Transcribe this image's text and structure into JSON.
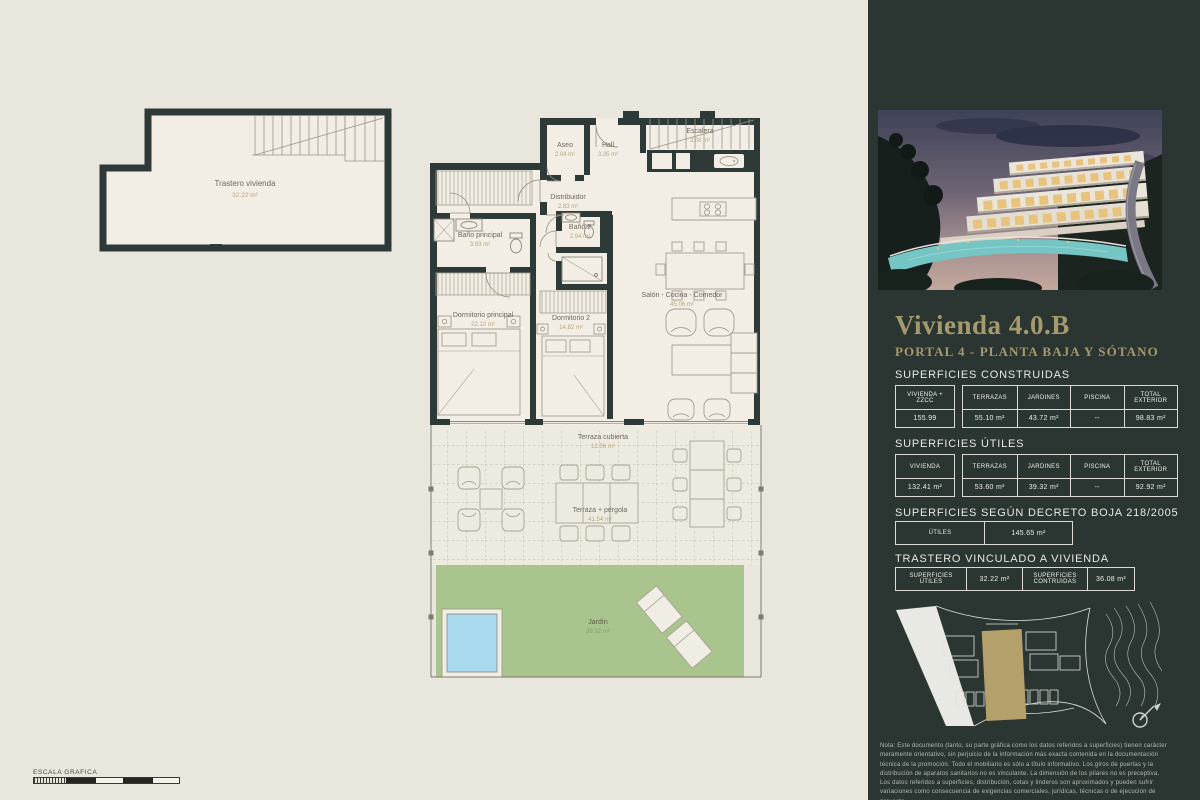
{
  "colors": {
    "accent_gold": "#a59a6c",
    "sidebar_bg": "#2b3532",
    "wall": "#2e3a38",
    "garden_green": "#a9c48c",
    "pool_blue": "#a9d9ef",
    "floor": "#f2eee5"
  },
  "floorplan": {
    "trastero": {
      "name": "Trastero vivienda",
      "area": "32.22 m²"
    },
    "rooms": {
      "aseo": {
        "name": "Aseo",
        "area": "2.04 m²"
      },
      "hall": {
        "name": "Hall",
        "area": "3.35 m²"
      },
      "escalera": {
        "name": "Escalera",
        "area": "3.08 m²"
      },
      "distribuidor": {
        "name": "Distribuidor",
        "area": "2.83 m²"
      },
      "bano_principal": {
        "name": "Baño principal",
        "area": "3.63 m²"
      },
      "bano2": {
        "name": "Baño 2",
        "area": "2.94 m²"
      },
      "dormitorio_principal": {
        "name": "Dormitorio principal",
        "area": "22.12 m²"
      },
      "dormitorio2": {
        "name": "Dormitorio 2",
        "area": "14.82 m²"
      },
      "salon": {
        "name": "Salón - Cocina - Comedor",
        "area": "45.06 m²"
      },
      "terraza_cubierta": {
        "name": "Terraza cubierta",
        "area": "12.06 m²"
      },
      "terraza_pergola": {
        "name": "Terraza + pérgola",
        "area": "41.54 m²"
      },
      "jardin": {
        "name": "Jardín",
        "area": "39.32 m²"
      }
    },
    "scale_label": "ESCALA GRAFICA"
  },
  "sidebar": {
    "title": "Vivienda 4.0.B",
    "subtitle": "PORTAL 4 - PLANTA BAJA Y SÓTANO",
    "construidas": {
      "heading": "SUPERFICIES CONSTRUIDAS",
      "col1_header": "VIVIENDA + ZZCC",
      "col1_value": "155.99",
      "headers": [
        "TERRAZAS",
        "JARDINES",
        "PISCINA",
        "TOTAL EXTERIOR"
      ],
      "values": [
        "55.10 m²",
        "43.72 m²",
        "--",
        "98.83 m²"
      ]
    },
    "utiles": {
      "heading": "SUPERFICIES ÚTILES",
      "col1_header": "VIVIENDA",
      "col1_value": "132.41 m²",
      "headers": [
        "TERRAZAS",
        "JARDINES",
        "PISCINA",
        "TOTAL EXTERIOR"
      ],
      "values": [
        "53.60 m²",
        "39.32 m²",
        "--",
        "92.92 m²"
      ]
    },
    "decreto": {
      "heading": "SUPERFICIES SEGÚN DECRETO BOJA 218/2005",
      "label": "ÚTILES",
      "value": "145.65 m²"
    },
    "trastero_tbl": {
      "heading": "TRASTERO VINCULADO A VIVIENDA",
      "cells": [
        "SUPERFICIES ÚTILES",
        "32.22 m²",
        "SUPERFICIES CONTRUIDAS",
        "36.08 m²"
      ]
    },
    "disclaimer": "Nota: Este documento (tanto, su parte gráfica como los datos referidos a superficies) tienen carácter meramente orientativo, sin perjuicio de la información más exacta contenida en la documentación técnica de la promoción. Todo el mobiliario es sólo a título informativo. Los giros de puertas y la distribución de aparatos sanitarios no es vinculante. La dimensión de los pilares no es preceptiva. Los datos referidos a superficies, distribución, cotas y linderos son aproximados y pueden sufrir variaciones como consecuencia de exigencias comerciales, jurídicas, técnicas o de ejecución de proyecto."
  }
}
